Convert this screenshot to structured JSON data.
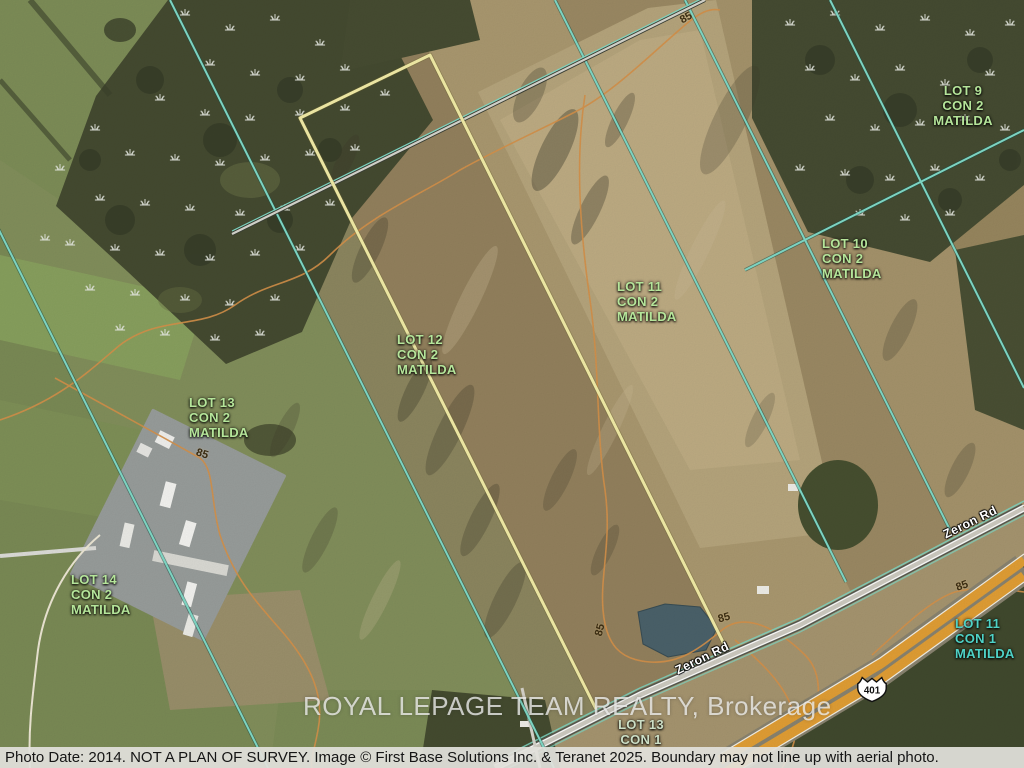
{
  "map": {
    "watermark": "ROYAL LEPAGE TEAM REALTY, Brokerage",
    "footer": "Photo Date: 2014. NOT A PLAN OF SURVEY. Image © First Base Solutions Inc. & Teranet 2025. Boundary may not line up with aerial photo.",
    "highway_shield": "401",
    "lot_labels": [
      {
        "id": "lot-9",
        "lines": [
          "LOT 9",
          "CON 2",
          "MATILDA"
        ]
      },
      {
        "id": "lot-10",
        "lines": [
          "LOT 10",
          "CON 2",
          "MATILDA"
        ]
      },
      {
        "id": "lot-11-con2",
        "lines": [
          "LOT 11",
          "CON 2",
          "MATILDA"
        ]
      },
      {
        "id": "lot-12",
        "lines": [
          "LOT 12",
          "CON 2",
          "MATILDA"
        ]
      },
      {
        "id": "lot-13-con2",
        "lines": [
          "LOT 13",
          "CON 2",
          "MATILDA"
        ]
      },
      {
        "id": "lot-14",
        "lines": [
          "LOT 14",
          "CON 2",
          "MATILDA"
        ]
      },
      {
        "id": "lot-11-con1",
        "lines": [
          "LOT 11",
          "CON 1",
          "MATILDA"
        ]
      },
      {
        "id": "lot-13-con1",
        "lines": [
          "LOT 13",
          "CON 1"
        ]
      }
    ],
    "road_labels": [
      {
        "id": "zeron-1",
        "text": "Zeron Rd"
      },
      {
        "id": "zeron-2",
        "text": "Zeron Rd"
      }
    ],
    "contour_labels": [
      {
        "id": "c85-1",
        "text": "85"
      },
      {
        "id": "c85-2",
        "text": "85"
      },
      {
        "id": "c85-3",
        "text": "85"
      },
      {
        "id": "c85-4",
        "text": "85"
      },
      {
        "id": "c85-5",
        "text": "85"
      }
    ],
    "colors": {
      "lot_label_green": "#b5e59a",
      "lot_label_teal": "#4ed2c6",
      "boundary_teal": "#82dcc9",
      "boundary_yellow": "#f4eea8",
      "contour_orange": "#d7924a",
      "highway_orange": "#e29f35"
    }
  }
}
